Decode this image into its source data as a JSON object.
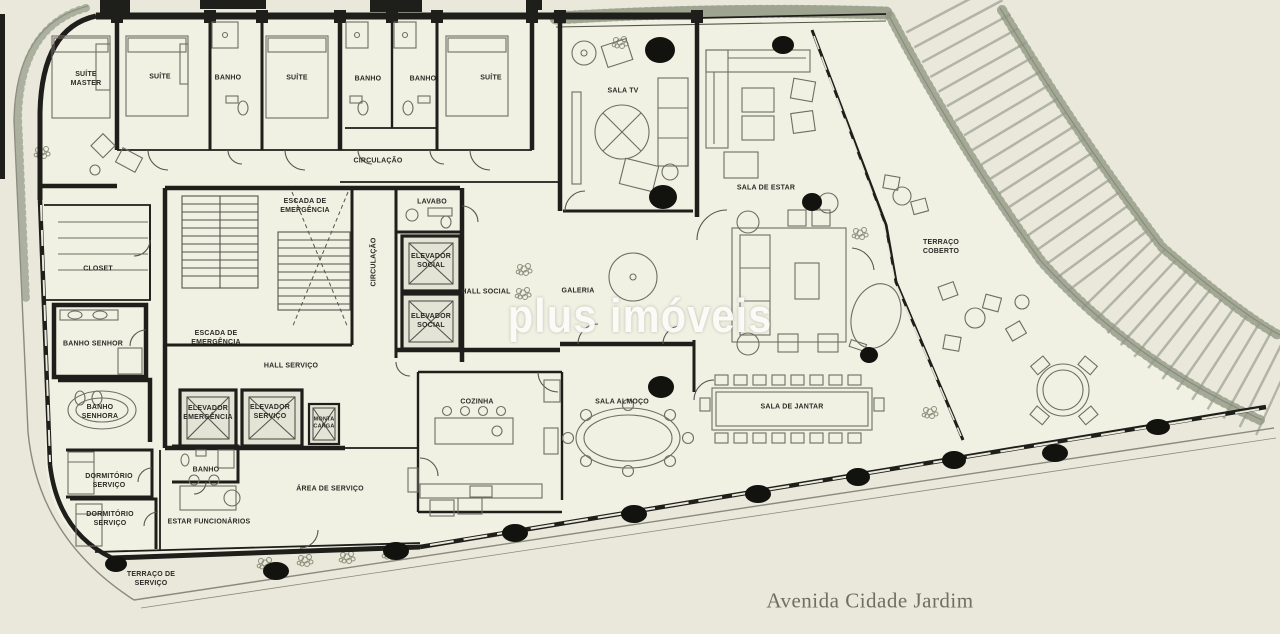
{
  "theme": {
    "paper": "#e9e8da",
    "interior": "#f0f0e3",
    "ink": "#1e1e1a",
    "furniture": "#6d6d64",
    "veg": "#929884",
    "column": "#12120e",
    "label": "#2b2b27",
    "watermark": "#fbfbf8",
    "street-text": "#6e6e62"
  },
  "watermark": {
    "text": "plus imóveis"
  },
  "street": {
    "label": "Avenida Cidade Jardim"
  },
  "rooms": [
    {
      "id": "suite-master",
      "label": "SUÍTE MASTER"
    },
    {
      "id": "suite-1",
      "label": "SUÍTE"
    },
    {
      "id": "banho-1",
      "label": "BANHO"
    },
    {
      "id": "suite-2",
      "label": "SUÍTE"
    },
    {
      "id": "banho-2",
      "label": "BANHO"
    },
    {
      "id": "banho-3",
      "label": "BANHO"
    },
    {
      "id": "suite-3",
      "label": "SUÍTE"
    },
    {
      "id": "circulacao",
      "label": "CIRCULAÇÃO"
    },
    {
      "id": "escada-emergencia-1",
      "label": "ESCADA DE EMERGÊNCIA"
    },
    {
      "id": "lavabo",
      "label": "LAVABO"
    },
    {
      "id": "circulacao-vertical",
      "label": "CIRCULAÇÃO"
    },
    {
      "id": "elevador-social-1",
      "label": "ELEVADOR SOCIAL"
    },
    {
      "id": "elevador-social-2",
      "label": "ELEVADOR SOCIAL"
    },
    {
      "id": "hall-social",
      "label": "HALL SOCIAL"
    },
    {
      "id": "galeria",
      "label": "GALERIA"
    },
    {
      "id": "sala-tv",
      "label": "SALA TV"
    },
    {
      "id": "sala-de-estar",
      "label": "SALA DE ESTAR"
    },
    {
      "id": "terraco-coberto",
      "label": "TERRAÇO COBERTO"
    },
    {
      "id": "closet",
      "label": "CLOSET"
    },
    {
      "id": "banho-senhor",
      "label": "BANHO SENHOR"
    },
    {
      "id": "escada-emergencia-2",
      "label": "ESCADA DE EMERGÊNCIA"
    },
    {
      "id": "hall-servico",
      "label": "HALL SERVIÇO"
    },
    {
      "id": "banho-senhora",
      "label": "BANHO SENHORA"
    },
    {
      "id": "elevador-emergencia",
      "label": "ELEVADOR EMERGÊNCIA"
    },
    {
      "id": "elevador-servico",
      "label": "ELEVADOR SERVIÇO"
    },
    {
      "id": "monta-carga",
      "label": "MONTA CARGA"
    },
    {
      "id": "cozinha",
      "label": "COZINHA"
    },
    {
      "id": "sala-almoco",
      "label": "SALA ALMOÇO"
    },
    {
      "id": "sala-de-jantar",
      "label": "SALA DE JANTAR"
    },
    {
      "id": "banho-servico",
      "label": "BANHO"
    },
    {
      "id": "dormitorio-servico-1",
      "label": "DORMITÓRIO SERVIÇO"
    },
    {
      "id": "dormitorio-servico-2",
      "label": "DORMITÓRIO SERVIÇO"
    },
    {
      "id": "estar-funcionarios",
      "label": "ESTAR FUNCIONÁRIOS"
    },
    {
      "id": "area-de-servico",
      "label": "ÁREA DE SERVIÇO"
    },
    {
      "id": "terraco-de-servico",
      "label": "TERRAÇO DE SERVIÇO"
    }
  ]
}
